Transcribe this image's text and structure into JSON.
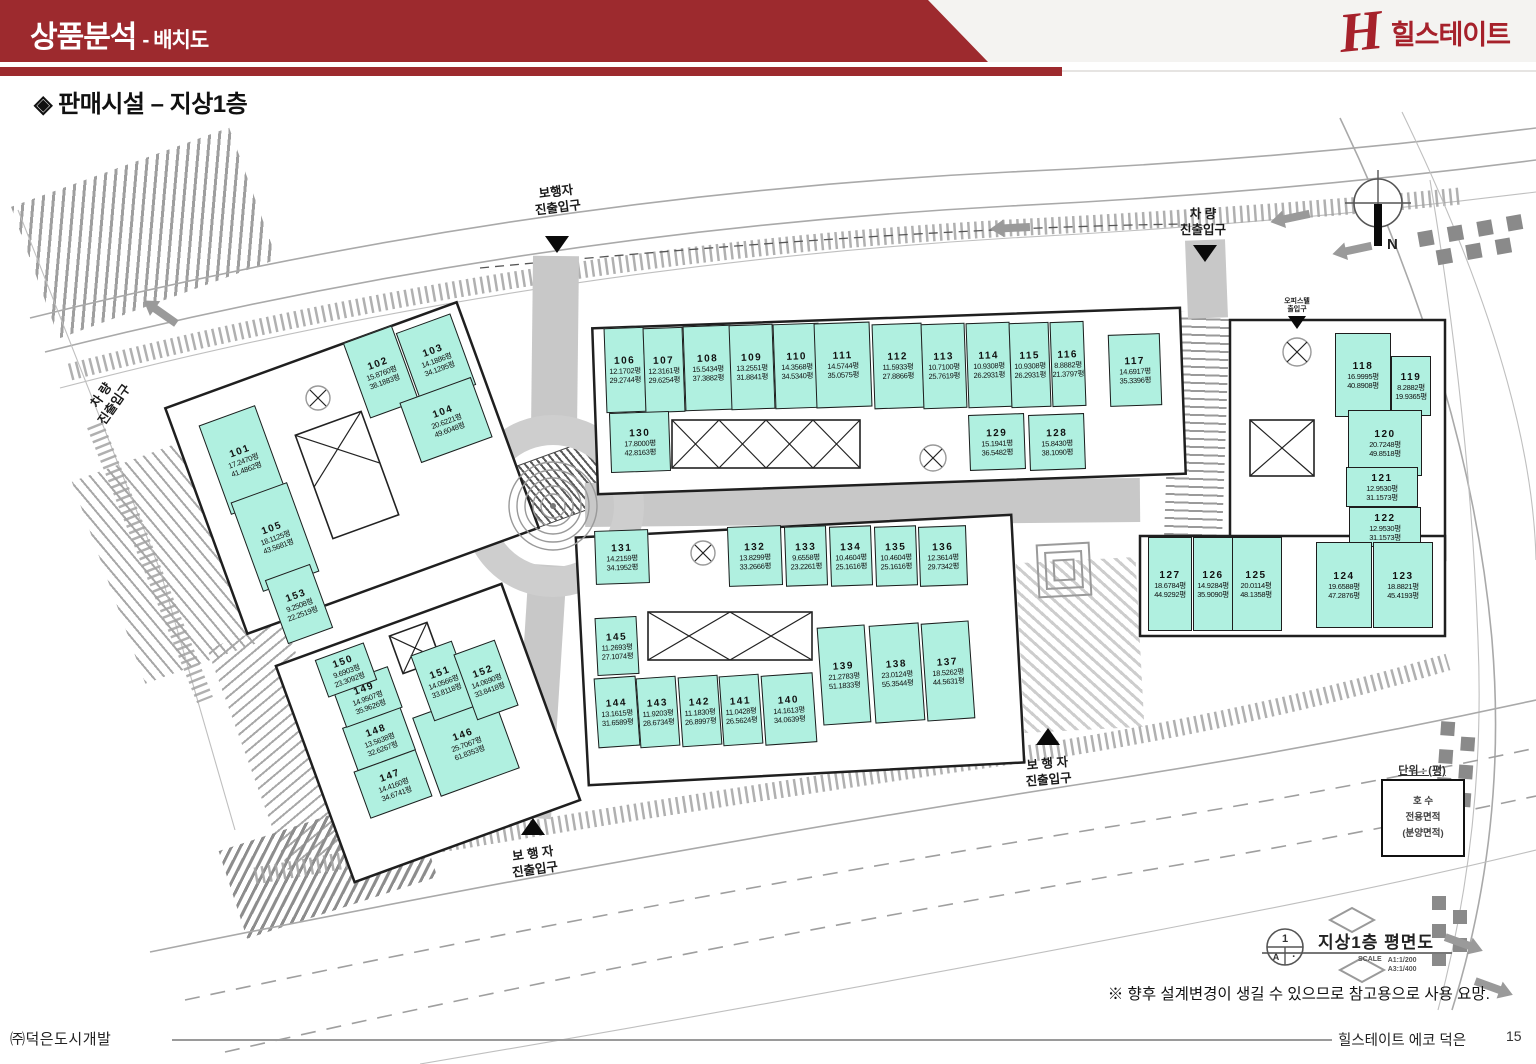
{
  "header": {
    "title": "상품분석",
    "subtitle": "- 배치도",
    "logo_h": "H",
    "logo_text": "힐스테이트",
    "accent_red": "#9d2a2e",
    "logo_red": "#a6212b"
  },
  "page": {
    "section_title": "◈ 판매시설 – 지상1층",
    "note": "※ 향후 설계변경이 생길 수 있으므로 참고용으로 사용 요망.",
    "footer_left": "㈜덕은도시개발",
    "footer_right": "힐스테이트 에코 덕은",
    "page_number": "15"
  },
  "plan": {
    "colors": {
      "unit_fill": "#b0f0e0"
    },
    "labels": {
      "ped_top": "보행자\n진출입구",
      "veh_top": "차  량\n진출입구",
      "veh_left": "차  량\n진출입구",
      "officetel": "오피스텔\n출입구",
      "ped_mid": "보 행 자\n진출입구",
      "ped_bottom": "보 행 자\n진출입구",
      "north": "N",
      "plan_title": "지상1층 평면도",
      "scale": "SCALE",
      "scale_a1": "A1:1/200",
      "scale_a3": "A3:1/400",
      "unit_note": "단위 : (평)",
      "legend_line1": "호  수",
      "legend_line2": "전용면적",
      "legend_line3": "(분양면적)",
      "symbol_top": "1",
      "symbol_left": "A",
      "symbol_right": "·"
    },
    "units": [
      {
        "no": "101",
        "a1": "17.2470평",
        "a2": "41.4862평",
        "x": 243,
        "y": 460,
        "w": 60,
        "h": 95,
        "r": -20
      },
      {
        "no": "102",
        "a1": "15.8760평",
        "a2": "38.1883평",
        "x": 381,
        "y": 372,
        "w": 52,
        "h": 80,
        "r": -20
      },
      {
        "no": "103",
        "a1": "14.1886평",
        "a2": "34.1295평",
        "x": 436,
        "y": 359,
        "w": 58,
        "h": 76,
        "r": -20
      },
      {
        "no": "104",
        "a1": "20.6221평",
        "a2": "49.6048평",
        "x": 446,
        "y": 420,
        "w": 76,
        "h": 64,
        "r": -20
      },
      {
        "no": "105",
        "a1": "18.1125평",
        "a2": "43.5681평",
        "x": 275,
        "y": 537,
        "w": 60,
        "h": 95,
        "r": -20
      },
      {
        "no": "106",
        "a1": "12.1702평",
        "a2": "29.2744평",
        "x": 625,
        "y": 370,
        "w": 40,
        "h": 85,
        "r": -2
      },
      {
        "no": "107",
        "a1": "12.3161평",
        "a2": "29.6254평",
        "x": 664,
        "y": 370,
        "w": 40,
        "h": 85,
        "r": -2
      },
      {
        "no": "108",
        "a1": "15.5434평",
        "a2": "37.3882평",
        "x": 708,
        "y": 368,
        "w": 48,
        "h": 85,
        "r": -2
      },
      {
        "no": "109",
        "a1": "13.2551평",
        "a2": "31.8841평",
        "x": 752,
        "y": 367,
        "w": 44,
        "h": 85,
        "r": -2
      },
      {
        "no": "110",
        "a1": "14.3568평",
        "a2": "34.5340평",
        "x": 797,
        "y": 366,
        "w": 46,
        "h": 85,
        "r": -2
      },
      {
        "no": "111",
        "a1": "14.5744평",
        "a2": "35.0575평",
        "x": 843,
        "y": 365,
        "w": 56,
        "h": 85,
        "r": -2
      },
      {
        "no": "112",
        "a1": "11.5933평",
        "a2": "27.8866평",
        "x": 898,
        "y": 366,
        "w": 50,
        "h": 85,
        "r": -2
      },
      {
        "no": "113",
        "a1": "10.7100평",
        "a2": "25.7619평",
        "x": 944,
        "y": 366,
        "w": 44,
        "h": 85,
        "r": -2
      },
      {
        "no": "114",
        "a1": "10.9308평",
        "a2": "26.2931평",
        "x": 989,
        "y": 365,
        "w": 44,
        "h": 85,
        "r": -2
      },
      {
        "no": "115",
        "a1": "10.9308평",
        "a2": "26.2931평",
        "x": 1030,
        "y": 365,
        "w": 40,
        "h": 85,
        "r": -2
      },
      {
        "no": "116",
        "a1": "8.8882평",
        "a2": "21.3797평",
        "x": 1068,
        "y": 364,
        "w": 34,
        "h": 85,
        "r": -2
      },
      {
        "no": "117",
        "a1": "14.6917평",
        "a2": "35.3396평",
        "x": 1135,
        "y": 370,
        "w": 52,
        "h": 72,
        "r": -2
      },
      {
        "no": "118",
        "a1": "16.9995평",
        "a2": "40.8908평",
        "x": 1363,
        "y": 375,
        "w": 56,
        "h": 84,
        "r": 0
      },
      {
        "no": "119",
        "a1": "8.2882평",
        "a2": "19.9365평",
        "x": 1411,
        "y": 386,
        "w": 40,
        "h": 60,
        "r": 0
      },
      {
        "no": "120",
        "a1": "20.7248평",
        "a2": "49.8518평",
        "x": 1385,
        "y": 443,
        "w": 74,
        "h": 66,
        "r": 0
      },
      {
        "no": "121",
        "a1": "12.9530평",
        "a2": "31.1573평",
        "x": 1382,
        "y": 487,
        "w": 72,
        "h": 40,
        "r": 0
      },
      {
        "no": "122",
        "a1": "12.9530평",
        "a2": "31.1573평",
        "x": 1385,
        "y": 527,
        "w": 72,
        "h": 40,
        "r": 0
      },
      {
        "no": "123",
        "a1": "18.8821평",
        "a2": "45.4193평",
        "x": 1403,
        "y": 585,
        "w": 60,
        "h": 86,
        "r": 0
      },
      {
        "no": "124",
        "a1": "19.6588평",
        "a2": "47.2876평",
        "x": 1344,
        "y": 585,
        "w": 56,
        "h": 86,
        "r": 0
      },
      {
        "no": "125",
        "a1": "20.0114평",
        "a2": "48.1358평",
        "x": 1256,
        "y": 584,
        "w": 52,
        "h": 94,
        "r": 0
      },
      {
        "no": "126",
        "a1": "14.9284평",
        "a2": "35.9090평",
        "x": 1213,
        "y": 584,
        "w": 40,
        "h": 94,
        "r": 0
      },
      {
        "no": "127",
        "a1": "18.6784평",
        "a2": "44.9292평",
        "x": 1170,
        "y": 584,
        "w": 44,
        "h": 94,
        "r": 0
      },
      {
        "no": "128",
        "a1": "15.8430평",
        "a2": "38.1090평",
        "x": 1057,
        "y": 442,
        "w": 56,
        "h": 56,
        "r": -2
      },
      {
        "no": "129",
        "a1": "15.1941평",
        "a2": "36.5482평",
        "x": 997,
        "y": 442,
        "w": 56,
        "h": 56,
        "r": -2
      },
      {
        "no": "130",
        "a1": "17.8000평",
        "a2": "42.8163평",
        "x": 640,
        "y": 442,
        "w": 60,
        "h": 60,
        "r": -2
      },
      {
        "no": "131",
        "a1": "14.2159평",
        "a2": "34.1952평",
        "x": 622,
        "y": 557,
        "w": 54,
        "h": 54,
        "r": -2
      },
      {
        "no": "132",
        "a1": "13.8299평",
        "a2": "33.2666평",
        "x": 755,
        "y": 556,
        "w": 54,
        "h": 60,
        "r": -2
      },
      {
        "no": "133",
        "a1": "9.6558평",
        "a2": "23.2261평",
        "x": 806,
        "y": 556,
        "w": 42,
        "h": 60,
        "r": -2
      },
      {
        "no": "134",
        "a1": "10.4604평",
        "a2": "25.1616평",
        "x": 851,
        "y": 556,
        "w": 42,
        "h": 60,
        "r": -2
      },
      {
        "no": "135",
        "a1": "10.4604평",
        "a2": "25.1616평",
        "x": 896,
        "y": 556,
        "w": 42,
        "h": 60,
        "r": -2
      },
      {
        "no": "136",
        "a1": "12.3614평",
        "a2": "29.7342평",
        "x": 943,
        "y": 556,
        "w": 48,
        "h": 60,
        "r": -2
      },
      {
        "no": "137",
        "a1": "18.5262평",
        "a2": "44.5631평",
        "x": 948,
        "y": 671,
        "w": 48,
        "h": 98,
        "r": -4
      },
      {
        "no": "138",
        "a1": "23.0124평",
        "a2": "55.3544평",
        "x": 897,
        "y": 673,
        "w": 50,
        "h": 98,
        "r": -4
      },
      {
        "no": "139",
        "a1": "21.2783평",
        "a2": "51.1833평",
        "x": 844,
        "y": 675,
        "w": 48,
        "h": 98,
        "r": -4
      },
      {
        "no": "140",
        "a1": "14.1613평",
        "a2": "34.0639평",
        "x": 789,
        "y": 709,
        "w": 52,
        "h": 70,
        "r": -4
      },
      {
        "no": "141",
        "a1": "11.0428평",
        "a2": "26.5624평",
        "x": 741,
        "y": 710,
        "w": 40,
        "h": 70,
        "r": -4
      },
      {
        "no": "142",
        "a1": "11.1830평",
        "a2": "26.8997평",
        "x": 700,
        "y": 711,
        "w": 40,
        "h": 70,
        "r": -4
      },
      {
        "no": "143",
        "a1": "11.9203평",
        "a2": "28.6734평",
        "x": 658,
        "y": 712,
        "w": 40,
        "h": 70,
        "r": -4
      },
      {
        "no": "144",
        "a1": "13.1615평",
        "a2": "31.6589평",
        "x": 617,
        "y": 712,
        "w": 42,
        "h": 70,
        "r": -4
      },
      {
        "no": "145",
        "a1": "11.2693평",
        "a2": "27.1074평",
        "x": 617,
        "y": 646,
        "w": 42,
        "h": 58,
        "r": -3
      },
      {
        "no": "146",
        "a1": "25.7067평",
        "a2": "61.8353평",
        "x": 466,
        "y": 743,
        "w": 84,
        "h": 84,
        "r": -20
      },
      {
        "no": "147",
        "a1": "14.4160평",
        "a2": "34.6741평",
        "x": 393,
        "y": 784,
        "w": 66,
        "h": 50,
        "r": -20
      },
      {
        "no": "148",
        "a1": "13.5638평",
        "a2": "32.6267평",
        "x": 379,
        "y": 739,
        "w": 62,
        "h": 46,
        "r": -20
      },
      {
        "no": "149",
        "a1": "14.9507평",
        "a2": "35.9626평",
        "x": 367,
        "y": 697,
        "w": 60,
        "h": 44,
        "r": -20
      },
      {
        "no": "150",
        "a1": "9.6903평",
        "a2": "23.3092평",
        "x": 346,
        "y": 670,
        "w": 52,
        "h": 40,
        "r": -20
      },
      {
        "no": "151",
        "a1": "14.0566평",
        "a2": "33.8118평",
        "x": 443,
        "y": 681,
        "w": 44,
        "h": 70,
        "r": -20
      },
      {
        "no": "152",
        "a1": "14.0690평",
        "a2": "33.8418평",
        "x": 486,
        "y": 680,
        "w": 44,
        "h": 70,
        "r": -20
      },
      {
        "no": "153",
        "a1": "9.2508평",
        "a2": "22.2519평",
        "x": 299,
        "y": 604,
        "w": 48,
        "h": 68,
        "r": -20
      }
    ]
  }
}
